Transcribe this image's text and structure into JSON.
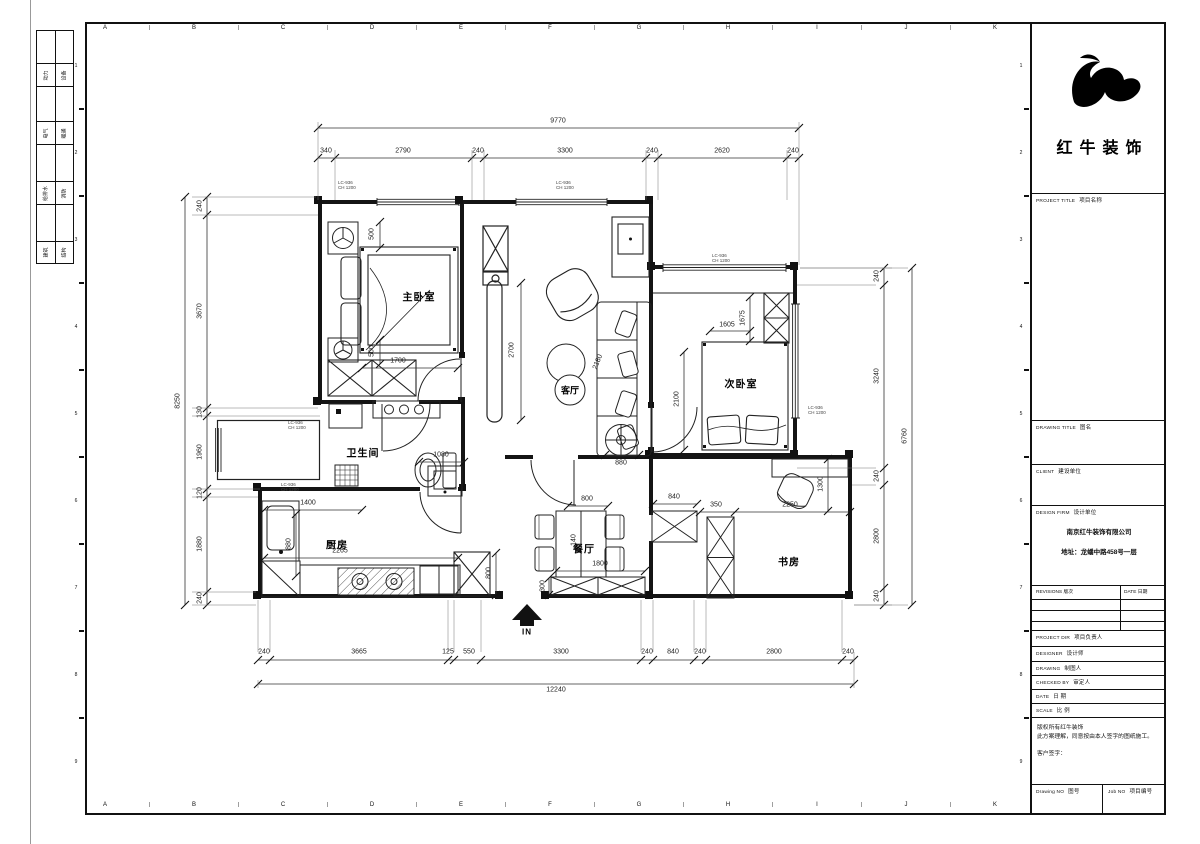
{
  "sheet": {
    "grid_letters": [
      "A",
      "B",
      "C",
      "D",
      "E",
      "F",
      "G",
      "H",
      "I",
      "J",
      "K"
    ],
    "side_numbers": [
      "1",
      "2",
      "3",
      "4",
      "5",
      "6",
      "7",
      "8",
      "9"
    ]
  },
  "signoff": {
    "rows": [
      {
        "l": "动力",
        "r": "设备"
      },
      {
        "l": "电气",
        "r": "暖通"
      },
      {
        "l": "给排水",
        "r": "消防"
      },
      {
        "l": "建筑",
        "r": "结构"
      }
    ]
  },
  "logo": {
    "company": "红牛装饰"
  },
  "title_block": {
    "project_title_en": "PROJECT TITLE",
    "project_title_cn": "项目名称",
    "drawing_title_en": "DRAWING TITLE",
    "drawing_title_cn": "图名",
    "client_en": "CLIENT",
    "client_cn": "建设单位",
    "design_firm_en": "DESIGN FIRM",
    "design_firm_cn": "设计单位",
    "firm_name": "南京红牛装饰有限公司",
    "firm_address": "地址：龙蟠中路458号一层",
    "revisions_en": "REVISIONS",
    "revisions_cn": "版次",
    "date_col_en": "DATE",
    "date_col_cn": "日期",
    "rows": [
      {
        "en": "PROJECT DIR",
        "cn": "项目负责人"
      },
      {
        "en": "DESIGNER",
        "cn": "设计师"
      },
      {
        "en": "DRAWING",
        "cn": "制图人"
      },
      {
        "en": "CHECKED BY",
        "cn": "审定人"
      },
      {
        "en": "DATE",
        "cn": "日  期"
      },
      {
        "en": "SCALE",
        "cn": "比  例"
      }
    ],
    "notes": [
      "版权所有红牛装饰",
      "此方案理解，同意按由本人签字的图纸施工。",
      "客户签字："
    ],
    "drawing_no_en": "Drawing NO",
    "drawing_no_cn": "图号",
    "job_no_en": "Job NO",
    "job_no_cn": "项目编号"
  },
  "plan": {
    "rooms": [
      {
        "name": "主卧室",
        "x": 419,
        "y": 296,
        "sm": 0
      },
      {
        "name": "次卧室",
        "x": 741,
        "y": 383,
        "sm": 0
      },
      {
        "name": "卫生间",
        "x": 363,
        "y": 452,
        "sm": 0
      },
      {
        "name": "厨房",
        "x": 337,
        "y": 544,
        "sm": 0
      },
      {
        "name": "餐厅",
        "x": 584,
        "y": 548,
        "sm": 0
      },
      {
        "name": "客厅",
        "x": 570,
        "y": 390,
        "sm": 1
      },
      {
        "name": "书房",
        "x": 789,
        "y": 561,
        "sm": 0
      }
    ],
    "entry_label": "IN",
    "window_tags": [
      {
        "l1": "LC-936",
        "l2": "CH 1200",
        "x": 338,
        "y": 180
      },
      {
        "l1": "LC-936",
        "l2": "CH 1200",
        "x": 556,
        "y": 180
      },
      {
        "l1": "LC-936",
        "l2": "CH 1200",
        "x": 712,
        "y": 253
      },
      {
        "l1": "LC-936",
        "l2": "CH 1200",
        "x": 808,
        "y": 405
      },
      {
        "l1": "LC-936",
        "l2": "CH 1200",
        "x": 288,
        "y": 420
      },
      {
        "l1": "LC-936",
        "l2": "CH 1200",
        "x": 281,
        "y": 482
      }
    ]
  },
  "dims": {
    "top": {
      "total": {
        "t": "9770",
        "x": 558,
        "y": 121
      },
      "segs": [
        {
          "t": "340",
          "x": 326,
          "y": 151
        },
        {
          "t": "2790",
          "x": 403,
          "y": 151
        },
        {
          "t": "240",
          "x": 478,
          "y": 151
        },
        {
          "t": "3300",
          "x": 565,
          "y": 151
        },
        {
          "t": "240",
          "x": 652,
          "y": 151
        },
        {
          "t": "2620",
          "x": 722,
          "y": 151
        },
        {
          "t": "240",
          "x": 793,
          "y": 151
        }
      ]
    },
    "bottom": {
      "total": {
        "t": "12240",
        "x": 556,
        "y": 690
      },
      "segs": [
        {
          "t": "240",
          "x": 264,
          "y": 652
        },
        {
          "t": "3665",
          "x": 359,
          "y": 652
        },
        {
          "t": "125",
          "x": 448,
          "y": 652
        },
        {
          "t": "550",
          "x": 469,
          "y": 652
        },
        {
          "t": "3300",
          "x": 561,
          "y": 652
        },
        {
          "t": "240",
          "x": 647,
          "y": 652
        },
        {
          "t": "840",
          "x": 673,
          "y": 652
        },
        {
          "t": "240",
          "x": 700,
          "y": 652
        },
        {
          "t": "2800",
          "x": 774,
          "y": 652
        },
        {
          "t": "240",
          "x": 848,
          "y": 652
        }
      ]
    },
    "left": {
      "total": {
        "t": "8250",
        "x": 178,
        "y": 401,
        "r": -90
      },
      "segs": [
        {
          "t": "240",
          "x": 200,
          "y": 206,
          "r": -90
        },
        {
          "t": "3670",
          "x": 200,
          "y": 311,
          "r": -90
        },
        {
          "t": "130",
          "x": 200,
          "y": 412,
          "r": -90
        },
        {
          "t": "1960",
          "x": 200,
          "y": 452,
          "r": -90
        },
        {
          "t": "120",
          "x": 200,
          "y": 493,
          "r": -90
        },
        {
          "t": "1880",
          "x": 200,
          "y": 544,
          "r": -90
        },
        {
          "t": "240",
          "x": 200,
          "y": 598,
          "r": -90
        }
      ]
    },
    "right": {
      "total": {
        "t": "6760",
        "x": 905,
        "y": 436,
        "r": -90
      },
      "segs": [
        {
          "t": "240",
          "x": 877,
          "y": 276,
          "r": -90
        },
        {
          "t": "3240",
          "x": 877,
          "y": 376,
          "r": -90
        },
        {
          "t": "240",
          "x": 877,
          "y": 476,
          "r": -90
        },
        {
          "t": "2800",
          "x": 877,
          "y": 536,
          "r": -90
        },
        {
          "t": "240",
          "x": 877,
          "y": 596,
          "r": -90
        }
      ]
    },
    "inner": [
      {
        "t": "2700",
        "x": 512,
        "y": 350,
        "r": -90
      },
      {
        "t": "880",
        "x": 621,
        "y": 463
      },
      {
        "t": "2180",
        "x": 598,
        "y": 362,
        "r": -68
      },
      {
        "t": "2100",
        "x": 677,
        "y": 399,
        "r": -90
      },
      {
        "t": "1675",
        "x": 743,
        "y": 318,
        "r": -90
      },
      {
        "t": "1605",
        "x": 727,
        "y": 325
      },
      {
        "t": "500",
        "x": 372,
        "y": 234,
        "r": -90
      },
      {
        "t": "500",
        "x": 372,
        "y": 351,
        "r": -90
      },
      {
        "t": "1700",
        "x": 398,
        "y": 361
      },
      {
        "t": "1080",
        "x": 441,
        "y": 455
      },
      {
        "t": "1400",
        "x": 308,
        "y": 503
      },
      {
        "t": "880",
        "x": 289,
        "y": 544,
        "r": -90
      },
      {
        "t": "2265",
        "x": 340,
        "y": 551
      },
      {
        "t": "800",
        "x": 489,
        "y": 573,
        "r": -90
      },
      {
        "t": "800",
        "x": 587,
        "y": 499
      },
      {
        "t": "1800",
        "x": 600,
        "y": 564
      },
      {
        "t": "300",
        "x": 543,
        "y": 586,
        "r": -90
      },
      {
        "t": "140",
        "x": 574,
        "y": 540,
        "r": -90
      },
      {
        "t": "840",
        "x": 674,
        "y": 497
      },
      {
        "t": "350",
        "x": 716,
        "y": 505
      },
      {
        "t": "2250",
        "x": 790,
        "y": 505
      },
      {
        "t": "1300",
        "x": 821,
        "y": 484,
        "r": -90
      }
    ]
  }
}
